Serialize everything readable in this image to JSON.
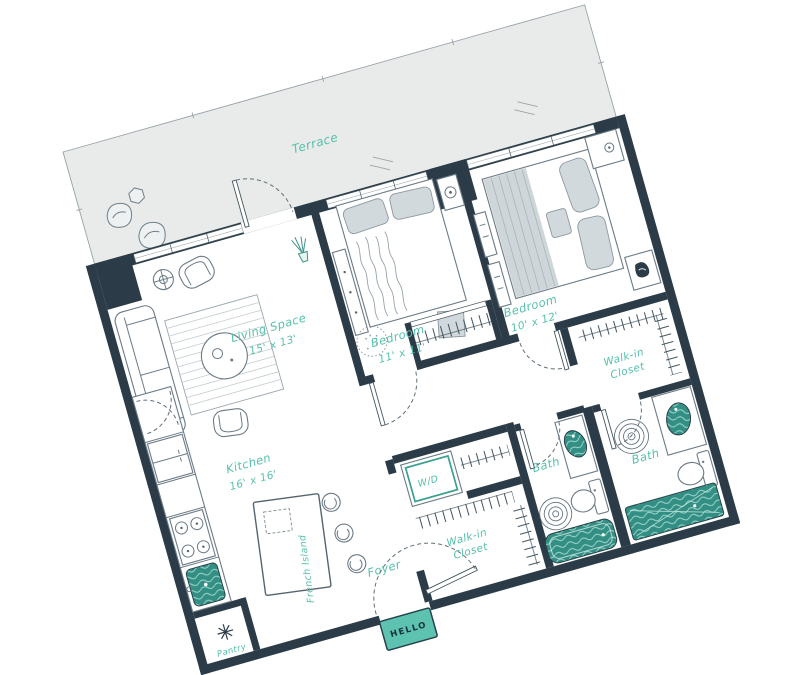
{
  "colors": {
    "wall": "#2b3c48",
    "terrace_fill": "#e8ebe9",
    "fixture_teal": "#338e83",
    "label_teal": "#55c1ab",
    "mat_teal": "#5ec2b1",
    "furniture_gray": "#6b7b86"
  },
  "rooms": {
    "terrace": {
      "label": "Terrace"
    },
    "living_space": {
      "label": "Living Space",
      "dims": "15' x 13'"
    },
    "bedroom_1": {
      "label": "Bedroom",
      "dims": "11' x 11'"
    },
    "bedroom_2": {
      "label": "Bedroom",
      "dims": "10' x 12'"
    },
    "walk_in_closet_1": {
      "label_line_1": "Walk-in",
      "label_line_2": "Closet"
    },
    "walk_in_closet_2": {
      "label_line_1": "Walk-in",
      "label_line_2": "Closet"
    },
    "bath_1": {
      "label": "Bath"
    },
    "bath_2": {
      "label": "Bath"
    },
    "kitchen": {
      "label": "Kitchen",
      "dims": "16' x 16'"
    },
    "kitchen_island": {
      "label": "French Island"
    },
    "foyer": {
      "label": "Foyer"
    },
    "pantry": {
      "label": "Pantry"
    },
    "laundry_closet": {
      "label": "W/D"
    },
    "entry_mat": {
      "label": "HELLO"
    }
  }
}
